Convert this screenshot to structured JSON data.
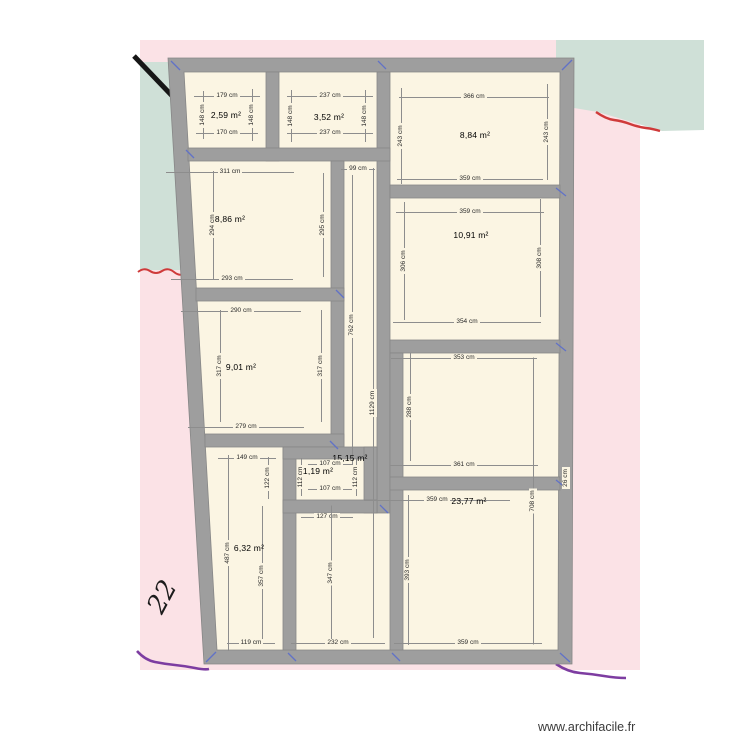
{
  "watermark": "www.archifacile.fr",
  "map": {
    "parcel_label": "22"
  },
  "colors": {
    "wall_fill": "#9e9e9e",
    "wall_edge": "#878787",
    "floor": "#fbf5e3",
    "map_pink": "#fbe2e6",
    "map_green": "#cfe0d7",
    "dim_color": "#2a2a2a",
    "corner_arrow": "#5b6ecc",
    "squiggle_red": "#cf3a3a",
    "squiggle_purple": "#7d3da1",
    "watermark_color": "#3a3a3a"
  },
  "plan": {
    "unit": "cm",
    "rooms": [
      {
        "name": "room-2-59",
        "area": "2,59 m²",
        "label": {
          "x": 226,
          "y": 115
        },
        "dims": [
          {
            "t": "179 cm",
            "x": 227,
            "y": 96,
            "o": "h",
            "l": 66
          },
          {
            "t": "170 cm",
            "x": 227,
            "y": 133,
            "o": "h",
            "l": 62
          },
          {
            "t": "148 cm",
            "x": 203,
            "y": 115,
            "o": "v",
            "l": 48
          },
          {
            "t": "148 cm",
            "x": 252,
            "y": 115,
            "o": "v",
            "l": 52
          }
        ]
      },
      {
        "name": "room-3-52",
        "area": "3,52 m²",
        "label": {
          "x": 329,
          "y": 117
        },
        "dims": [
          {
            "t": "237 cm",
            "x": 330,
            "y": 96,
            "o": "h",
            "l": 86
          },
          {
            "t": "237 cm",
            "x": 330,
            "y": 133,
            "o": "h",
            "l": 86
          },
          {
            "t": "148 cm",
            "x": 291,
            "y": 116,
            "o": "v",
            "l": 52
          },
          {
            "t": "148 cm",
            "x": 365,
            "y": 116,
            "o": "v",
            "l": 52
          }
        ]
      },
      {
        "name": "room-8-84",
        "area": "8,84 m²",
        "label": {
          "x": 475,
          "y": 135
        },
        "dims": [
          {
            "t": "366 cm",
            "x": 474,
            "y": 97,
            "o": "h",
            "l": 150
          },
          {
            "t": "359 cm",
            "x": 470,
            "y": 179,
            "o": "h",
            "l": 146
          },
          {
            "t": "243 cm",
            "x": 401,
            "y": 136,
            "o": "v",
            "l": 96
          },
          {
            "t": "243 cm",
            "x": 547,
            "y": 132,
            "o": "v",
            "l": 96
          }
        ]
      },
      {
        "name": "room-8-86",
        "area": "8,86 m²",
        "label": {
          "x": 230,
          "y": 219
        },
        "dims": [
          {
            "t": "311 cm",
            "x": 230,
            "y": 172,
            "o": "h",
            "l": 128
          },
          {
            "t": "293 cm",
            "x": 232,
            "y": 279,
            "o": "h",
            "l": 122
          },
          {
            "t": "294 cm",
            "x": 213,
            "y": 225,
            "o": "v",
            "l": 108
          },
          {
            "t": "295 cm",
            "x": 323,
            "y": 225,
            "o": "v",
            "l": 104
          }
        ]
      },
      {
        "name": "room-10-91",
        "area": "10,91 m²",
        "label": {
          "x": 471,
          "y": 235
        },
        "dims": [
          {
            "t": "359 cm",
            "x": 470,
            "y": 212,
            "o": "h",
            "l": 148
          },
          {
            "t": "354 cm",
            "x": 467,
            "y": 322,
            "o": "h",
            "l": 148
          },
          {
            "t": "306 cm",
            "x": 404,
            "y": 261,
            "o": "v",
            "l": 118
          },
          {
            "t": "308 cm",
            "x": 540,
            "y": 258,
            "o": "v",
            "l": 118
          }
        ]
      },
      {
        "name": "room-9-01",
        "area": "9,01 m²",
        "label": {
          "x": 241,
          "y": 367
        },
        "dims": [
          {
            "t": "290 cm",
            "x": 241,
            "y": 311,
            "o": "h",
            "l": 120
          },
          {
            "t": "279 cm",
            "x": 246,
            "y": 427,
            "o": "h",
            "l": 116
          },
          {
            "t": "317 cm",
            "x": 220,
            "y": 366,
            "o": "v",
            "l": 112
          },
          {
            "t": "317 cm",
            "x": 321,
            "y": 366,
            "o": "v",
            "l": 112
          }
        ]
      },
      {
        "name": "hall-15-15",
        "area": "15,15 m²",
        "label": {
          "x": 350,
          "y": 458
        },
        "dims": [
          {
            "t": "99 cm",
            "x": 358,
            "y": 169,
            "o": "h",
            "l": 34
          },
          {
            "t": "762 cm",
            "x": 352,
            "y": 325,
            "o": "v",
            "l": 300
          },
          {
            "t": "1129 cm",
            "x": 373,
            "y": 403,
            "o": "v",
            "l": 470
          },
          {
            "t": "127 cm",
            "x": 327,
            "y": 517,
            "o": "h",
            "l": 52
          },
          {
            "t": "347 cm",
            "x": 331,
            "y": 573,
            "o": "v",
            "l": 135
          },
          {
            "t": "232 cm",
            "x": 338,
            "y": 643,
            "o": "h",
            "l": 94
          }
        ]
      },
      {
        "name": "room-middle-right",
        "area": "",
        "label": null,
        "dims": [
          {
            "t": "353 cm",
            "x": 464,
            "y": 358,
            "o": "h",
            "l": 146
          },
          {
            "t": "361 cm",
            "x": 464,
            "y": 465,
            "o": "h",
            "l": 148
          },
          {
            "t": "288 cm",
            "x": 410,
            "y": 407,
            "o": "v",
            "l": 108
          }
        ]
      },
      {
        "name": "room-23-77",
        "area": "23,77 m²",
        "label": {
          "x": 469,
          "y": 501
        },
        "dims": [
          {
            "t": "359 cm",
            "x": 437,
            "y": 500,
            "o": "h",
            "l": 146
          },
          {
            "t": "359 cm",
            "x": 468,
            "y": 643,
            "o": "h",
            "l": 148
          },
          {
            "t": "393 cm",
            "x": 408,
            "y": 570,
            "o": "v",
            "l": 150
          },
          {
            "t": "708 cm",
            "x": 533,
            "y": 501,
            "o": "v",
            "l": 287
          },
          {
            "t": "26 cm",
            "x": 566,
            "y": 478,
            "o": "v",
            "l": 20
          }
        ]
      },
      {
        "name": "room-6-32",
        "area": "6,32 m²",
        "label": {
          "x": 249,
          "y": 548
        },
        "dims": [
          {
            "t": "487 cm",
            "x": 228,
            "y": 553,
            "o": "v",
            "l": 196
          },
          {
            "t": "357 cm",
            "x": 262,
            "y": 576,
            "o": "v",
            "l": 140
          },
          {
            "t": "119 cm",
            "x": 251,
            "y": 643,
            "o": "h",
            "l": 48
          },
          {
            "t": "149 cm",
            "x": 247,
            "y": 458,
            "o": "h",
            "l": 58
          },
          {
            "t": "122 cm",
            "x": 268,
            "y": 478,
            "o": "v",
            "l": 42
          }
        ]
      },
      {
        "name": "room-1-19",
        "area": "1,19 m²",
        "label": {
          "x": 318,
          "y": 471
        },
        "dims": [
          {
            "t": "107 cm",
            "x": 330,
            "y": 464,
            "o": "h",
            "l": 44
          },
          {
            "t": "107 cm",
            "x": 330,
            "y": 489,
            "o": "h",
            "l": 44
          },
          {
            "t": "112 cm",
            "x": 301,
            "y": 477,
            "o": "v",
            "l": 38
          },
          {
            "t": "112 cm",
            "x": 356,
            "y": 477,
            "o": "v",
            "l": 38
          }
        ]
      }
    ]
  }
}
